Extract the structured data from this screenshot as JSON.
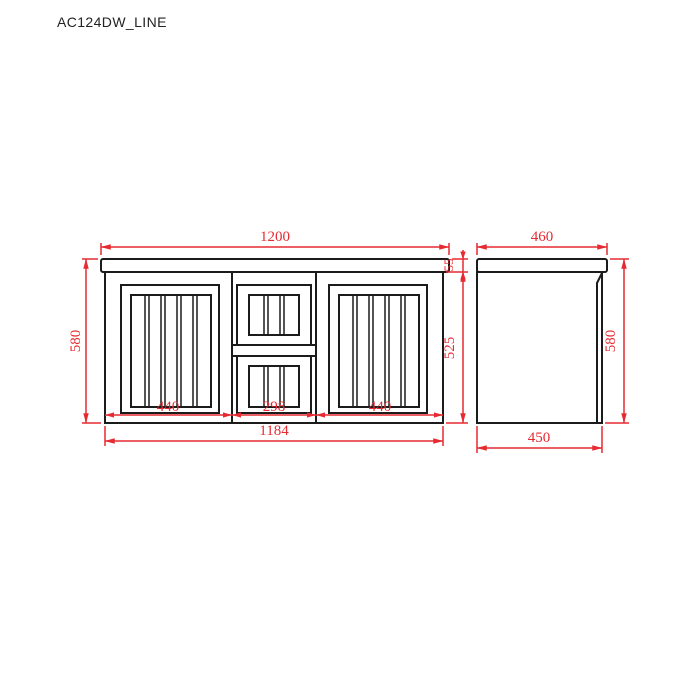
{
  "title": "AC124DW_LINE",
  "colors": {
    "dimension": "#e62a31",
    "line": "#1b1b1b",
    "background": "#ffffff"
  },
  "front_view": {
    "name": "vanity front elevation",
    "dim_top_width": "1200",
    "dim_left_height": "580",
    "dim_top_thickness": "55",
    "dim_body_height": "525",
    "dim_bottom_segments": [
      "440",
      "298",
      "440"
    ],
    "dim_bottom_width": "1184"
  },
  "side_view": {
    "name": "vanity side elevation",
    "dim_top_depth": "460",
    "dim_right_height": "580",
    "dim_bottom_depth": "450"
  }
}
